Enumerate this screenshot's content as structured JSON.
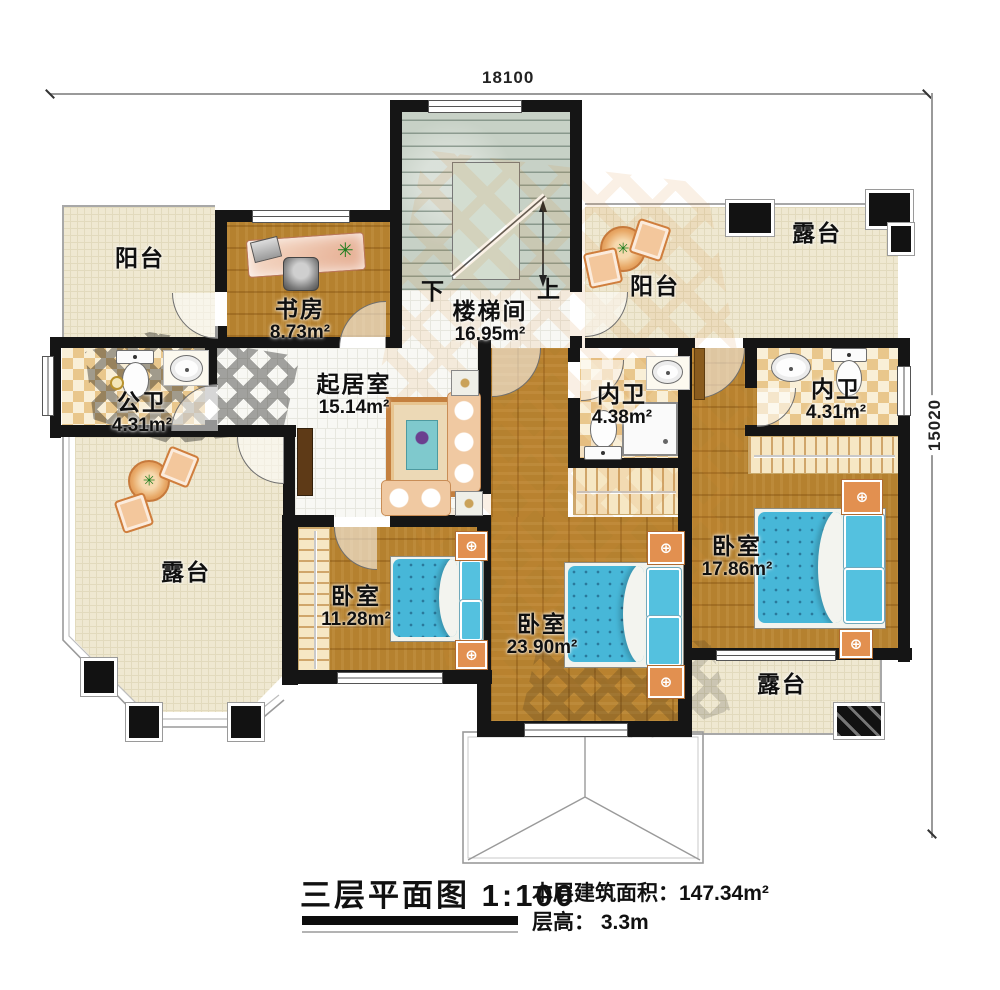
{
  "title_block": {
    "name": "三层平面图",
    "scale": "1:100",
    "area_label": "本层建筑面积：",
    "area_value": "147.34m²",
    "floor_height_label": "层高：",
    "floor_height_value": "3.3m"
  },
  "dimensions": {
    "top": "18100",
    "right": "15020"
  },
  "stair": {
    "down": "下",
    "up": "上"
  },
  "rooms": {
    "balcony_tl": {
      "name": "阳台"
    },
    "study": {
      "name": "书房",
      "area": "8.73m²"
    },
    "stairwell": {
      "name": "楼梯间",
      "area": "16.95m²"
    },
    "balcony_tr": {
      "name": "阳台"
    },
    "terrace_tr": {
      "name": "露台"
    },
    "bath_public": {
      "name": "公卫",
      "area": "4.31m²"
    },
    "living": {
      "name": "起居室",
      "area": "15.14m²"
    },
    "bath_en1": {
      "name": "内卫",
      "area": "4.38m²"
    },
    "bath_en2": {
      "name": "内卫",
      "area": "4.31m²"
    },
    "terrace_left": {
      "name": "露台"
    },
    "bedroom_small": {
      "name": "卧室",
      "area": "11.28m²"
    },
    "bedroom_large": {
      "name": "卧室",
      "area": "23.90m²"
    },
    "bedroom_right": {
      "name": "卧室",
      "area": "17.86m²"
    },
    "terrace_br": {
      "name": "露台"
    }
  },
  "colors": {
    "wall": "#151515",
    "wood_floor": "#b5812f",
    "cream_floor": "#efe8d1",
    "white_tile": "#f8f8f4",
    "bath_checker": "#e9c78c",
    "bed_blue": "#47b7d8",
    "furniture_orange": "#e29050",
    "stairs_green": "#c7d1c6"
  }
}
